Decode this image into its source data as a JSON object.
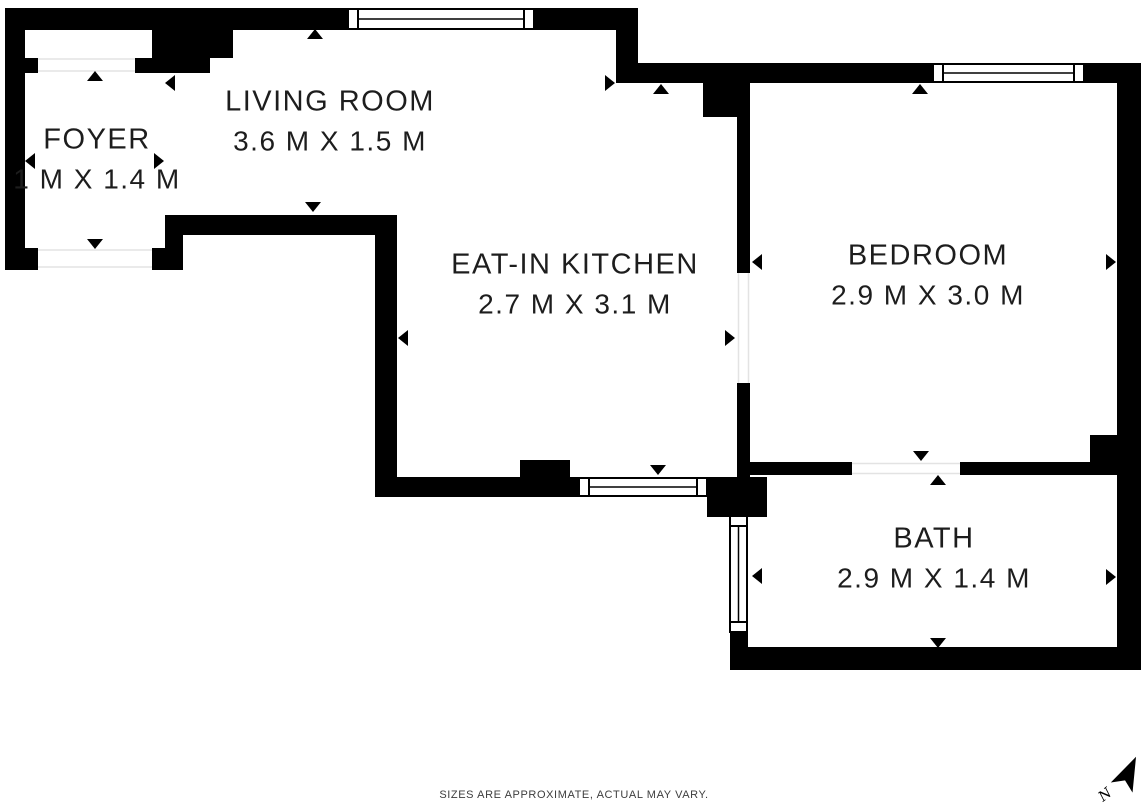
{
  "rooms": {
    "foyer": {
      "name": "FOYER",
      "dims": "1 M X 1.4 M"
    },
    "living_room": {
      "name": "LIVING ROOM",
      "dims": "3.6 M X 1.5 M"
    },
    "kitchen": {
      "name": "EAT-IN KITCHEN",
      "dims": "2.7 M X 3.1 M"
    },
    "bedroom": {
      "name": "BEDROOM",
      "dims": "2.9 M X 3.0 M"
    },
    "bath": {
      "name": "BATH",
      "dims": "2.9 M X 1.4 M"
    }
  },
  "footer": {
    "disclaimer": "SIZES ARE APPROXIMATE, ACTUAL MAY VARY."
  },
  "compass": {
    "label": "N"
  },
  "colors": {
    "wall": "#000000",
    "background": "#ffffff",
    "label_text": "#1d1d1d",
    "disclaimer_text": "#3d3d3d",
    "opening_line": "#e3e3e3"
  }
}
